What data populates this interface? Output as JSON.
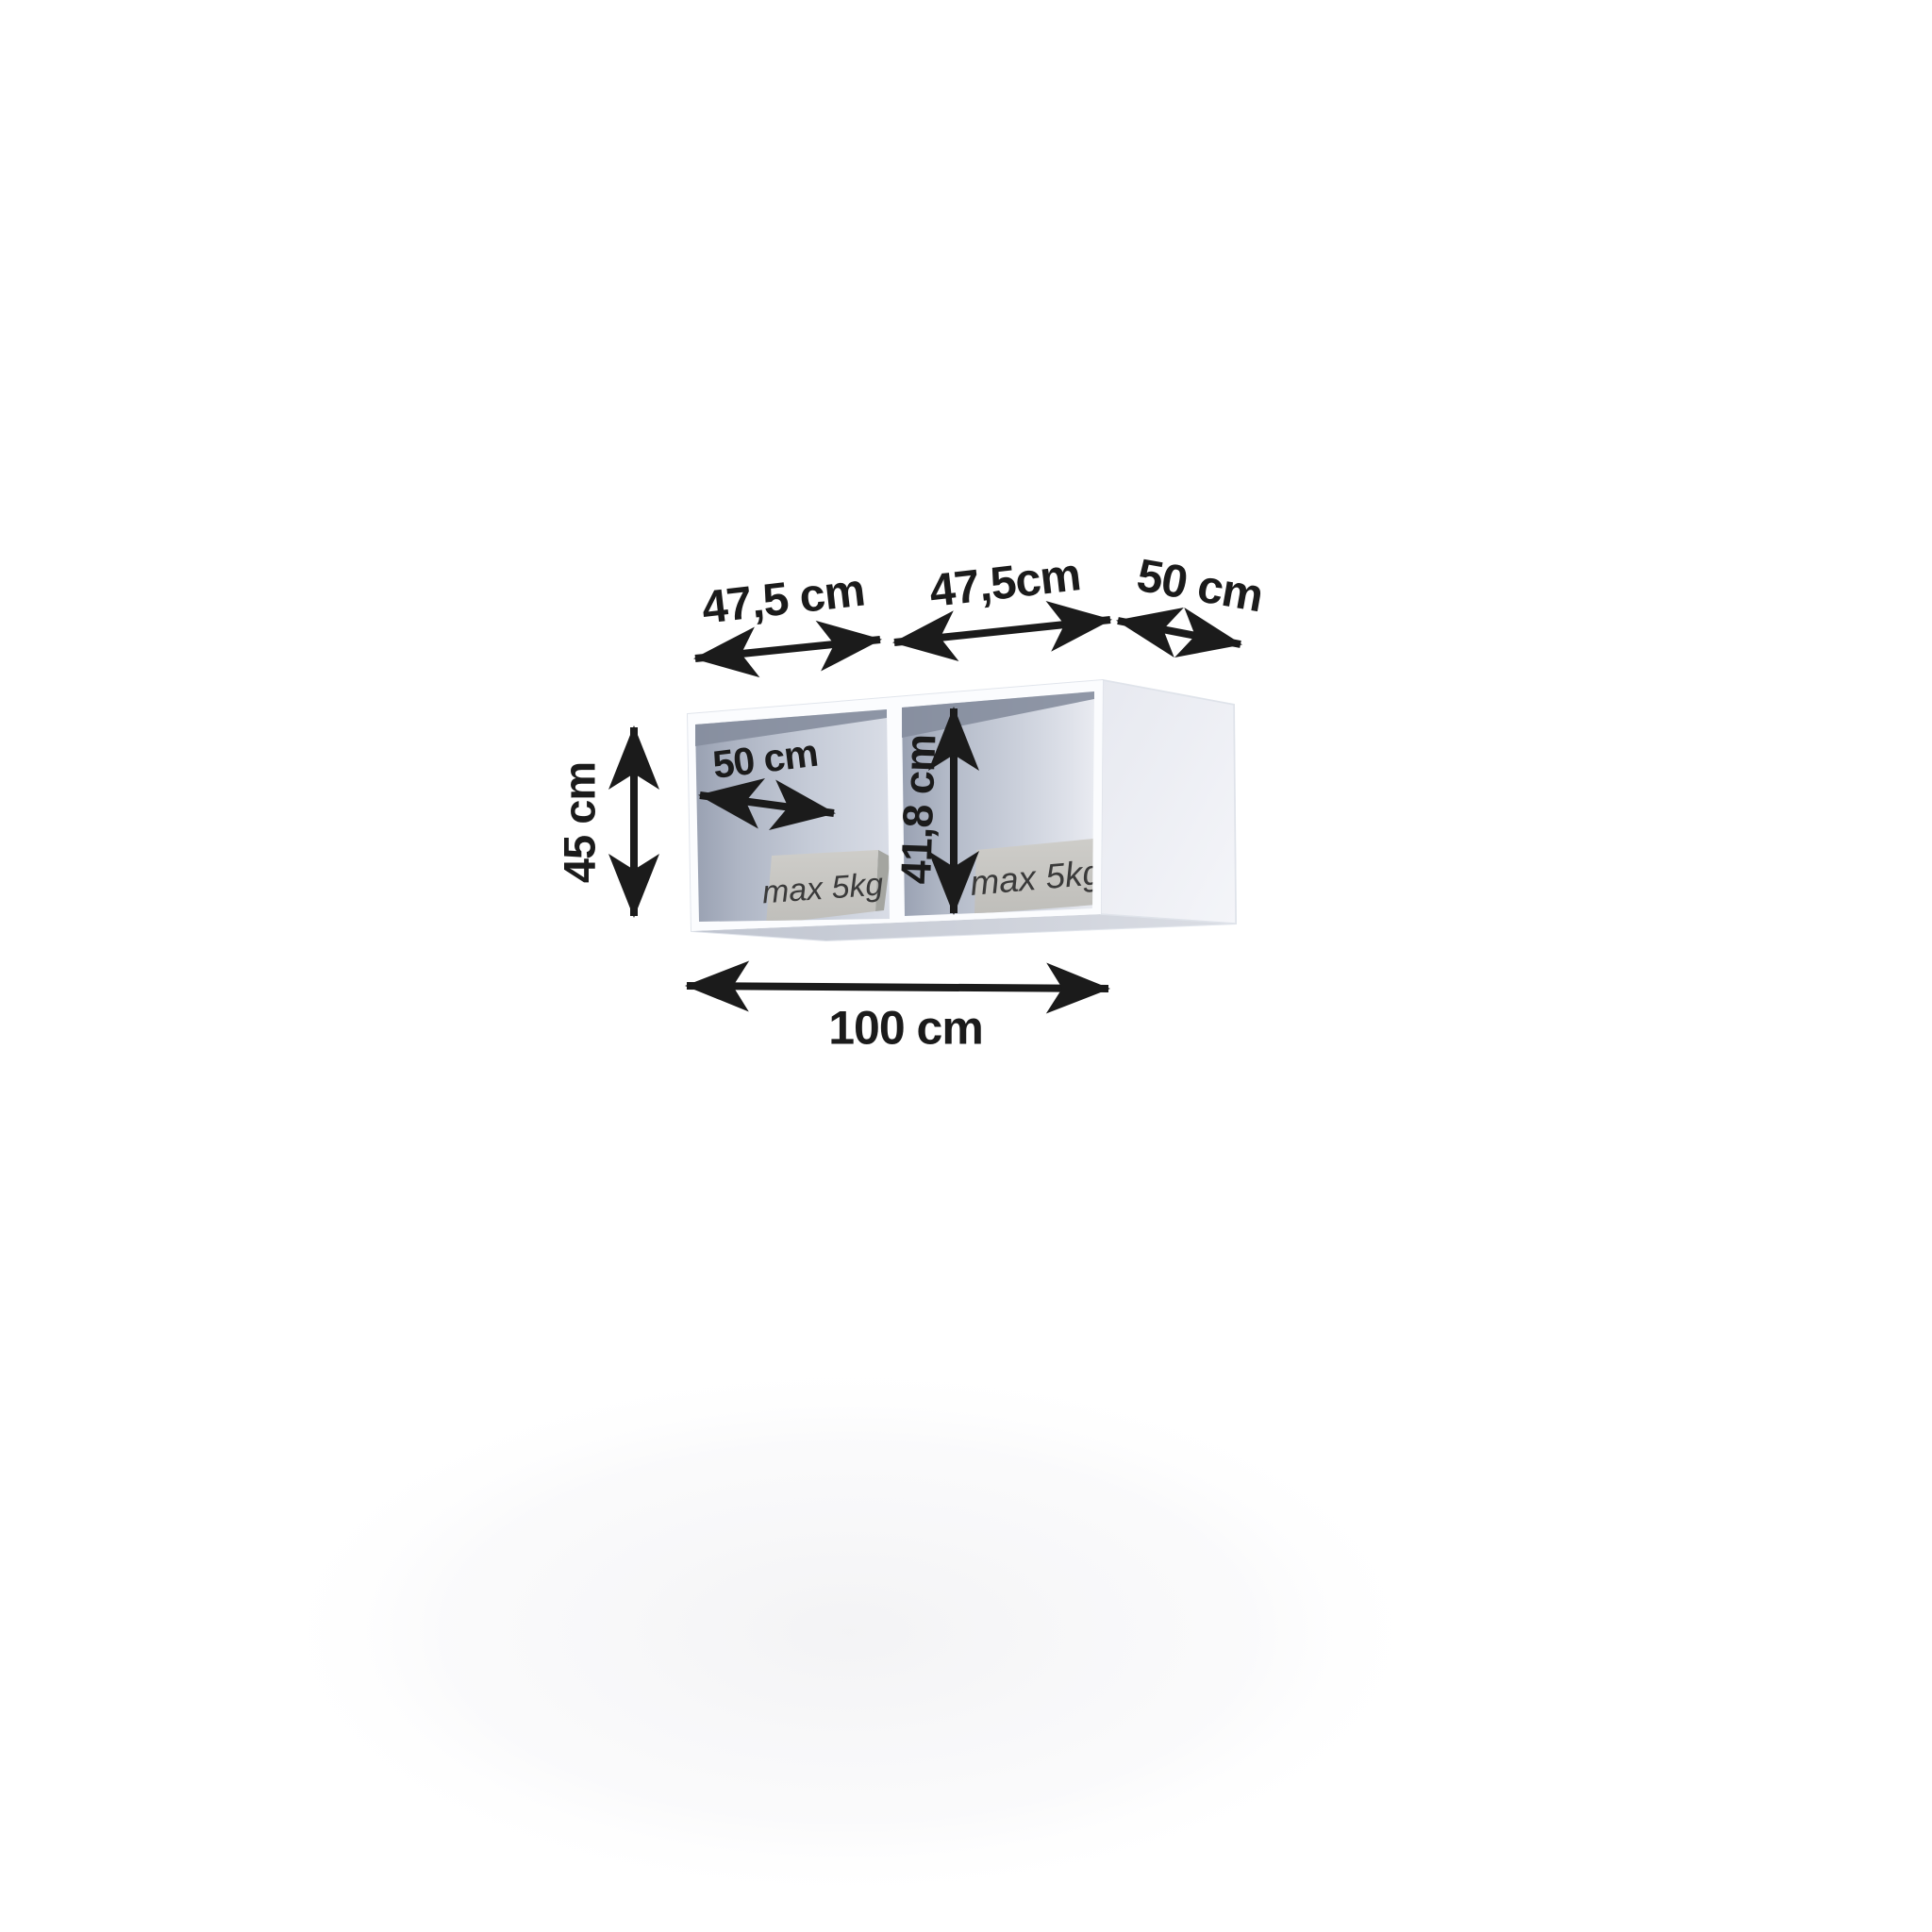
{
  "figure": {
    "dimensions": {
      "width_left_compartment": "47,5 cm",
      "width_right_compartment": "47,5cm",
      "depth_top": "50 cm",
      "height_outer": "45 cm",
      "depth_inner": "50 cm",
      "height_inner": "41,8 cm",
      "width_total": "100 cm"
    },
    "load_cards": {
      "left": "max 5kg",
      "right": "max 5kg"
    }
  },
  "colors": {
    "ink": "#1b1b1b",
    "cabinet_white": "#fbfcfe",
    "interior_dark": "#99a1b2",
    "interior_mid": "#c6ccd8",
    "interior_light": "#e6e9f0",
    "interior_top_shadow": "#858d9d",
    "side_panel": "#eceef3",
    "underside": "#c8ccd6",
    "card_face": "#c8c7c3",
    "card_edge": "#a4a5a0",
    "card_text": "#3a3a3a",
    "floor_glow": "#f3f3f5"
  }
}
